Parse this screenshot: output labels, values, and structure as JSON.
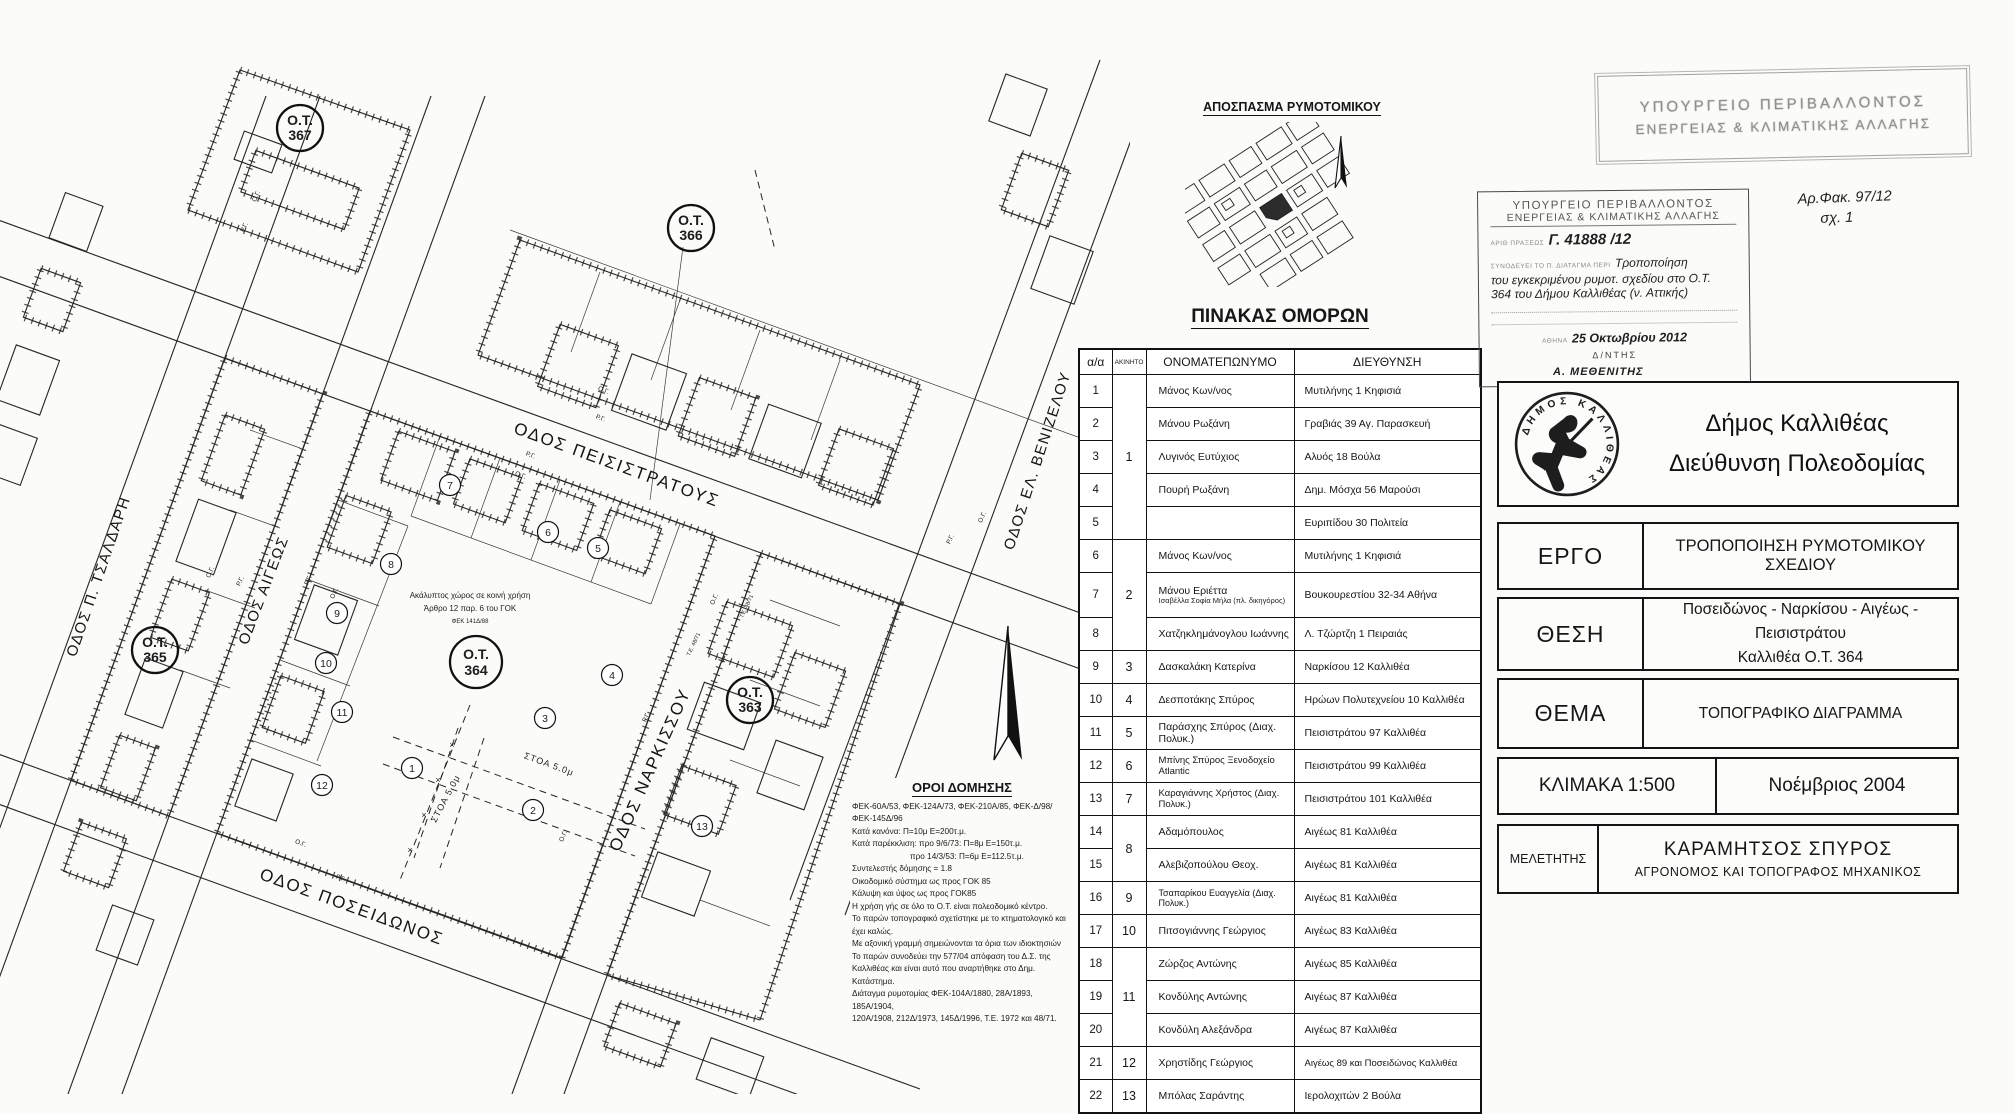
{
  "map": {
    "ot_prefix": "Ο.Τ.",
    "blocks": {
      "b367": "367",
      "b366": "366",
      "b365": "365",
      "b364": "364",
      "b363": "363"
    },
    "streets": {
      "tsaldari": "ΟΔΟΣ Π. ΤΣΑΛΔΑΡΗ",
      "aigeos": "ΟΔΟΣ ΑΙΓΕΩΣ",
      "peisistratous": "ΟΔΟΣ ΠΕΙΣΙΣΤΡΑΤΟΥΣ",
      "narkissou": "ΟΔΟΣ ΝΑΡΚΙΣΣΟΥ",
      "poseidonos": "ΟΔΟΣ ΠΟΣΕΙΔΩΝΟΣ",
      "venizelou": "ΟΔΟΣ ΕΛ. ΒΕΝΙΖΕΛΟΥ"
    },
    "lots": [
      "1",
      "2",
      "3",
      "4",
      "5",
      "6",
      "7",
      "8",
      "9",
      "10",
      "11",
      "12",
      "13"
    ],
    "stoa": "ΣΤΟΑ 5.0μ",
    "rg": "Ρ.Γ.",
    "og": "Ο.Γ.",
    "te": "Τ.Ε. 48/71",
    "x_mark": "×",
    "note": {
      "l1": "Ακάλυπτος χώρος σε κοινή χρήση",
      "l2": "Άρθρο 12 παρ. 6 του ΓΟΚ",
      "l3": "ΦΕΚ 141Δ/88"
    },
    "oroi": {
      "title": "ΟΡΟΙ ΔΟΜΗΣΗΣ",
      "lines": [
        "ΦΕΚ-60Α/53, ΦΕΚ-124Α/73, ΦΕΚ-210Α/85, ΦΕΚ-Δ/98/ΦΕΚ-145Δ/96",
        "Κατά κανόνα: Π=10μ Ε=200τ.μ.",
        "Κατά παρέκκλιση: προ 9/6/73: Π=8μ Ε=150τ.μ.",
        "προ 14/3/53: Π=6μ Ε=112.5τ.μ.",
        "Συντελεστής δόμησης = 1.8",
        "Οικοδομικό σύστημα ως προς ΓΟΚ 85",
        "Κάλυψη και ύψος ως προς ΓΟΚ85",
        "Η χρήση γής σε όλο το Ο.Τ. είναι πολεοδομικό κέντρο.",
        "Το παρών τοπογραφικό σχετίστηκε με το κτηματολογικό και έχει καλώς.",
        "Με αξονική γραμμή σημειώνονται τα όρια των ιδιοκτησιών",
        "Το παρών συνοδεύει την 577/04 απόφαση του Δ.Σ. της",
        "Καλλιθέας και είναι αυτό που αναρτήθηκε στο Δημ. Κατάστημα.",
        "Διάταγμα ρυμοτομίας ΦΕΚ-104Α/1880, 28Α/1893, 185Α/1904,",
        "120Α/1908, 212Δ/1973, 145Δ/1996, Τ.Ε. 1972 και 48/71."
      ]
    }
  },
  "inset": {
    "title": "ΑΠΟΣΠΑΣΜΑ ΡΥΜΟΤΟΜΙΚΟΥ"
  },
  "neighbors": {
    "title": "ΠΙΝΑΚΑΣ ΟΜΟΡΩΝ",
    "headers": [
      "α/α",
      "ΑΚΙΝΗΤΟ",
      "ΟΝΟΜΑΤΕΠΩΝΥΜΟ",
      "ΔΙΕΥΘΥΝΣΗ"
    ],
    "rows": [
      {
        "aa": "1",
        "prop": "1",
        "name": "Μάνος Κων/νος",
        "addr": "Μυτιλήνης 1 Κηφισιά"
      },
      {
        "aa": "2",
        "name": "Μάνου Ρωξάνη",
        "addr": "Γραβιάς 39 Αγ. Παρασκευή"
      },
      {
        "aa": "3",
        "name": "Λυγινός Ευτύχιος",
        "addr": "Αλυός 18 Βούλα"
      },
      {
        "aa": "4",
        "name": "Πουρή Ρωξάνη",
        "addr": "Δημ. Μόσχα 56 Μαρούσι"
      },
      {
        "aa": "5",
        "name": "Παπαγεωργίου Αγγέλα",
        "addr": "Ευριπίδου 30 Πολιτεία"
      },
      {
        "aa": "6",
        "prop": "2",
        "name": "Μάνος Κων/νος",
        "addr": "Μυτιλήνης 1 Κηφισιά"
      },
      {
        "aa": "7",
        "name": "Μάνου Εριέττα",
        "sub": "Ισαβέλλα Σοφία Μήλα (πλ. δικηγόρος)",
        "addr": "Βουκουρεστίου 32-34 Αθήνα"
      },
      {
        "aa": "8",
        "name": "Χατζηκλημάνογλου Ιωάννης",
        "addr": "Λ. Τζώρτζη 1 Πειραιάς"
      },
      {
        "aa": "9",
        "prop": "3",
        "name": "Δασκαλάκη Κατερίνα",
        "addr": "Ναρκίσου 12 Καλλιθέα"
      },
      {
        "aa": "10",
        "prop": "4",
        "name": "Δεσποτάκης Σπύρος",
        "addr": "Ηρώων Πολυτεχνείου 10 Καλλιθέα"
      },
      {
        "aa": "11",
        "prop": "5",
        "name": "Παράσχης Σπύρος (Διαχ. Πολυκ.)",
        "addr": "Πεισιστράτου 97 Καλλιθέα"
      },
      {
        "aa": "12",
        "prop": "6",
        "name": "Μπίνης Σπύρος Ξενοδοχείο Atlantic",
        "addr": "Πεισιστράτου 99 Καλλιθέα"
      },
      {
        "aa": "13",
        "prop": "7",
        "name": "Καραγιάννης Χρήστος (Διαχ. Πολυκ.)",
        "addr": "Πεισιστράτου 101 Καλλιθέα"
      },
      {
        "aa": "14",
        "prop": "8",
        "name": "Αδαμόπουλος",
        "addr": "Αιγέως 81 Καλλιθέα"
      },
      {
        "aa": "15",
        "name": "Αλεβιζοπούλου Θεοχ.",
        "addr": "Αιγέως 81 Καλλιθέα"
      },
      {
        "aa": "16",
        "prop": "9",
        "name": "Τσαπαρίκου Ευαγγελία (Διαχ. Πολυκ.)",
        "addr": "Αιγέως 81 Καλλιθέα"
      },
      {
        "aa": "17",
        "prop": "10",
        "name": "Πιτσογιάννης Γεώργιος",
        "addr": "Αιγέως 83 Καλλιθέα"
      },
      {
        "aa": "18",
        "prop": "11",
        "name": "Ζώρζος Αντώνης",
        "addr": "Αιγέως 85 Καλλιθέα"
      },
      {
        "aa": "19",
        "name": "Κονδύλης Αντώνης",
        "addr": "Αιγέως 87 Καλλιθέα"
      },
      {
        "aa": "20",
        "name": "Κονδύλη Αλεξάνδρα",
        "addr": "Αιγέως 87 Καλλιθέα"
      },
      {
        "aa": "21",
        "prop": "12",
        "name": "Χρηστίδης Γεώργιος",
        "addr": "Αιγέως 89 και Ποσειδώνος Καλλιθέα"
      },
      {
        "aa": "22",
        "prop": "13",
        "name": "Μπόλας Σαράντης",
        "addr": "Ιερολοχιτών 2 Βούλα"
      }
    ]
  },
  "stamps": {
    "faded": {
      "line1": "ΥΠΟΥΡΓΕΙΟ ΠΕΡΙΒΑΛΛΟΝΤΟΣ",
      "line2": "ΕΝΕΡΓΕΙΑΣ & ΚΛΙΜΑΤΙΚΗΣ ΑΛΛΑΓΗΣ"
    },
    "ministry": {
      "line1": "ΥΠΟΥΡΓΕΙΟ ΠΕΡΙΒΑΛΛΟΝΤΟΣ",
      "line2": "ΕΝΕΡΓΕΙΑΣ & ΚΛΙΜΑΤΙΚΗΣ ΑΛΛΑΓΗΣ",
      "praxis_label": "ΑΡΙΘ ΠΡΑΞΕΩΣ",
      "praxis_value": "Γ. 41888 /12",
      "decree_label": "ΣΥΝΟΔΕΥΕΙ ΤΟ Π. ΔΙΑΤΑΓΜΑ ΠΕΡΙ",
      "decree_line1": "Τροποποίηση",
      "decree_line2": "του εγκεκριμένου ρυμοτ. σχεδίου στο Ο.Τ.",
      "decree_line3": "364 του Δήμου Καλλιθέας (ν. Αττικής)",
      "city_label": "ΑΘΗΝΑ",
      "date_value": "25 Οκτωβρίου 2012",
      "signer": "Δ/ΝΤΗΣ"
    },
    "file_note_line1": "Αρ.Φακ. 97/12",
    "file_note_line2": "σχ. 1",
    "signature": "Α. ΜΕΘΕΝΙΤΗΣ"
  },
  "titleblock": {
    "municipality_line1": "Δήμος Καλλιθέας",
    "municipality_line2": "Διεύθυνση Πολεοδομίας",
    "seal_text": "ΔΗΜΟΣ ΚΑΛΛΙΘΕΑΣ",
    "ergo_label": "ΕΡΓΟ",
    "ergo_value": "ΤΡΟΠΟΠΟΙΗΣΗ ΡΥΜΟΤΟΜΙΚΟΥ ΣΧΕΔΙΟΥ",
    "thesi_label": "ΘΕΣΗ",
    "thesi_line1": "Ποσειδώνος - Ναρκίσου - Αιγέως - Πεισιστράτου",
    "thesi_line2": "Καλλιθέα  Ο.Τ. 364",
    "thema_label": "ΘΕΜΑ",
    "thema_value": "ΤΟΠΟΓΡΑΦΙΚΟ ΔΙΑΓΡΑΜΜΑ",
    "scale": "ΚΛΙΜΑΚΑ 1:500",
    "date": "Νοέμβριος 2004",
    "meletitis_label": "ΜΕΛΕΤΗΤΗΣ",
    "meletitis_name": "ΚΑΡΑΜΗΤΣΟΣ ΣΠΥΡΟΣ",
    "meletitis_title": "ΑΓΡΟΝΟΜΟΣ ΚΑΙ ΤΟΠΟΓΡΑΦΟΣ ΜΗΧΑΝΙΚΟΣ"
  }
}
